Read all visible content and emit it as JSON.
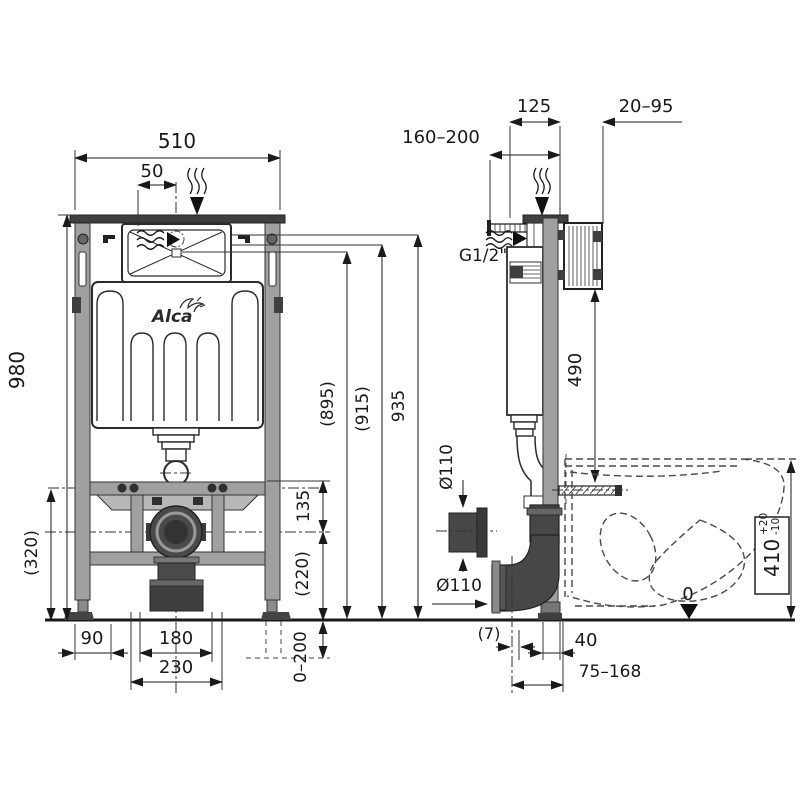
{
  "brand": "Alca",
  "left_view": {
    "frame_width": "510",
    "supply_offset": "50",
    "frame_height": "980",
    "height_895": "(895)",
    "height_915": "(915)",
    "height_935": "935",
    "dim_135": "135",
    "dim_320": "(320)",
    "dim_220": "(220)",
    "dim_90": "90",
    "dim_180": "180",
    "dim_230": "230",
    "dim_0_200": "0–200"
  },
  "right_view": {
    "dim_160_200": "160–200",
    "dim_125": "125",
    "dim_20_95": "20–95",
    "thread": "G1/2\"",
    "dim_490": "490",
    "pipe_diameter_side": "Ø110",
    "pipe_diameter_outlet": "Ø110",
    "dim_7": "(7)",
    "dim_40": "40",
    "dim_75_168": "75–168",
    "seat_height": "410",
    "seat_height_tol_plus": "+20",
    "seat_height_tol_minus": "-10",
    "floor_level": "0"
  }
}
